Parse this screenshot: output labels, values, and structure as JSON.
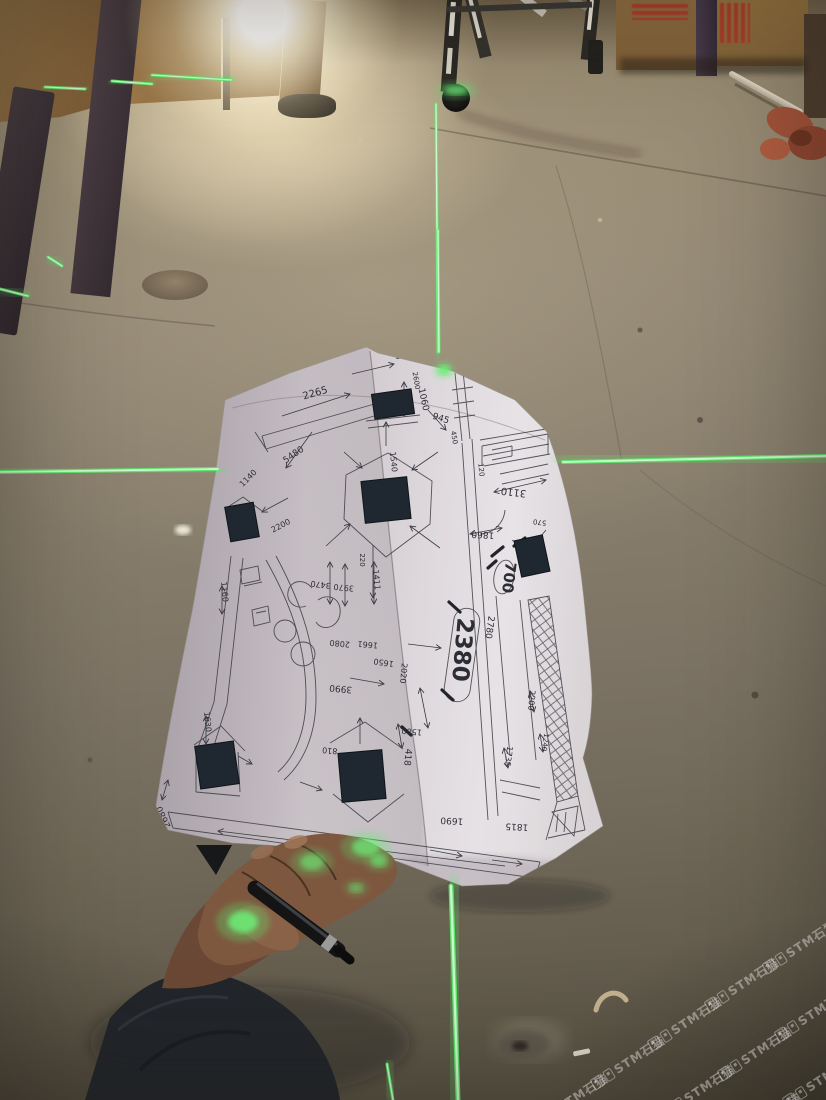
{
  "image": {
    "width": 826,
    "height": 1100
  },
  "colors": {
    "laser_green": "#5FE96C",
    "laser_core": "#D5FFD8",
    "paper_white": "#D8D2D6",
    "floor_brown": "#857B6A",
    "crate_wood": "#937042",
    "crate_print_red": "#B83426",
    "pillar_purple": "#443748",
    "pen_black": "#141414",
    "jacket_dark": "#22252A",
    "skin_shadow": "#6E4B38",
    "ink": "#2D2D36",
    "watermark_white": "#FFFFFF"
  },
  "watermark": {
    "text": "STM石猫",
    "icon": "stone-cat-logo-icon",
    "color": "#ffffff",
    "opacity": 0.38,
    "angle_deg": -33,
    "tiles": [
      [
        800,
        946
      ],
      [
        742,
        984
      ],
      [
        685,
        1023
      ],
      [
        628,
        1062
      ],
      [
        571,
        1100
      ],
      [
        812,
        1014
      ],
      [
        755,
        1053
      ],
      [
        698,
        1091
      ],
      [
        820,
        1080
      ],
      [
        764,
        1119
      ]
    ]
  },
  "laser": {
    "color": "#5FE96C",
    "segments": [
      {
        "x1": 0,
        "y1": 472,
        "x2": 218,
        "y2": 469,
        "w": 4,
        "glow": 9
      },
      {
        "x1": 563,
        "y1": 462,
        "x2": 826,
        "y2": 456,
        "w": 4,
        "glow": 9
      },
      {
        "x1": 436,
        "y1": 104,
        "x2": 438,
        "y2": 352,
        "w": 3,
        "glow": 6
      },
      {
        "x1": 438,
        "y1": 230,
        "x2": 439,
        "y2": 352,
        "w": 3,
        "glow": 7
      },
      {
        "x1": 451,
        "y1": 886,
        "x2": 458,
        "y2": 1100,
        "w": 5,
        "glow": 11
      },
      {
        "x1": 45,
        "y1": 87,
        "x2": 85,
        "y2": 89,
        "w": 3,
        "glow": 5
      },
      {
        "x1": 112,
        "y1": 81,
        "x2": 152,
        "y2": 84,
        "w": 3,
        "glow": 5
      },
      {
        "x1": 152,
        "y1": 75,
        "x2": 232,
        "y2": 80,
        "w": 3,
        "glow": 5
      },
      {
        "x1": 48,
        "y1": 257,
        "x2": 62,
        "y2": 266,
        "w": 3,
        "glow": 5
      },
      {
        "x1": 0,
        "y1": 289,
        "x2": 28,
        "y2": 296,
        "w": 3,
        "glow": 5
      },
      {
        "x1": 387,
        "y1": 1064,
        "x2": 393,
        "y2": 1100,
        "w": 3,
        "glow": 6
      }
    ],
    "spots": [
      {
        "cx": 444,
        "cy": 370,
        "rx": 6,
        "ry": 5,
        "o": 0.95
      },
      {
        "cx": 456,
        "cy": 90,
        "rx": 12,
        "ry": 5,
        "o": 0.7
      },
      {
        "cx": 243,
        "cy": 922,
        "rx": 15,
        "ry": 11,
        "o": 0.85
      },
      {
        "cx": 312,
        "cy": 862,
        "rx": 12,
        "ry": 8,
        "o": 0.6
      },
      {
        "cx": 366,
        "cy": 847,
        "rx": 14,
        "ry": 9,
        "o": 0.7
      },
      {
        "cx": 379,
        "cy": 861,
        "rx": 8,
        "ry": 6,
        "o": 0.6
      },
      {
        "cx": 356,
        "cy": 888,
        "rx": 7,
        "ry": 5,
        "o": 0.45
      }
    ]
  },
  "blueprint": {
    "labels": [
      {
        "t": "2160",
        "x": 406,
        "y": 357,
        "r": -12,
        "s": 8
      },
      {
        "t": "965",
        "x": 443,
        "y": 364,
        "r": -10,
        "s": 8
      },
      {
        "t": "2265",
        "x": 316,
        "y": 396,
        "r": -16,
        "s": 10
      },
      {
        "t": "2600",
        "x": 414,
        "y": 381,
        "r": 80,
        "s": 7
      },
      {
        "t": "1060",
        "x": 421,
        "y": 400,
        "r": 78,
        "s": 9
      },
      {
        "t": "945",
        "x": 440,
        "y": 421,
        "r": 18,
        "s": 9
      },
      {
        "t": "5480",
        "x": 295,
        "y": 457,
        "r": -35,
        "s": 9
      },
      {
        "t": "1540",
        "x": 391,
        "y": 462,
        "r": 85,
        "s": 8
      },
      {
        "t": "1140",
        "x": 250,
        "y": 480,
        "r": -45,
        "s": 8
      },
      {
        "t": "450",
        "x": 452,
        "y": 438,
        "r": 80,
        "s": 7
      },
      {
        "t": "120",
        "x": 479,
        "y": 470,
        "r": 85,
        "s": 7
      },
      {
        "t": "3110",
        "x": 514,
        "y": 489,
        "r": 187,
        "s": 10
      },
      {
        "t": "570",
        "x": 540,
        "y": 520,
        "r": 187,
        "s": 7
      },
      {
        "t": "1860",
        "x": 483,
        "y": 532,
        "r": 183,
        "s": 9
      },
      {
        "t": "700",
        "x": 504,
        "y": 577,
        "r": 97,
        "s": 15,
        "b": true
      },
      {
        "t": "2200",
        "x": 282,
        "y": 528,
        "r": -28,
        "s": 8
      },
      {
        "t": "3470",
        "x": 321,
        "y": 582,
        "r": 187,
        "s": 8
      },
      {
        "t": "3970",
        "x": 344,
        "y": 585,
        "r": 185,
        "s": 8
      },
      {
        "t": "1411",
        "x": 374,
        "y": 580,
        "r": 85,
        "s": 8
      },
      {
        "t": "220",
        "x": 360,
        "y": 560,
        "r": 90,
        "s": 7
      },
      {
        "t": "1160",
        "x": 222,
        "y": 592,
        "r": 85,
        "s": 8
      },
      {
        "t": "2080",
        "x": 340,
        "y": 641,
        "r": 185,
        "s": 8
      },
      {
        "t": "3990",
        "x": 341,
        "y": 686,
        "r": 185,
        "s": 9
      },
      {
        "t": "1650",
        "x": 384,
        "y": 660,
        "r": 188,
        "s": 8
      },
      {
        "t": "1661",
        "x": 368,
        "y": 642,
        "r": 185,
        "s": 8
      },
      {
        "t": "2020",
        "x": 401,
        "y": 673,
        "r": 95,
        "s": 8
      },
      {
        "t": "2380",
        "x": 455,
        "y": 649,
        "r": 95,
        "s": 23,
        "b": true
      },
      {
        "t": "2780",
        "x": 487,
        "y": 627,
        "r": 98,
        "s": 9
      },
      {
        "t": "1580",
        "x": 412,
        "y": 729,
        "r": 185,
        "s": 8
      },
      {
        "t": "418",
        "x": 405,
        "y": 757,
        "r": 95,
        "s": 9
      },
      {
        "t": "810",
        "x": 330,
        "y": 748,
        "r": 185,
        "s": 8
      },
      {
        "t": "1630",
        "x": 205,
        "y": 722,
        "r": 85,
        "s": 8
      },
      {
        "t": "1735",
        "x": 506,
        "y": 756,
        "r": 98,
        "s": 8
      },
      {
        "t": "2200",
        "x": 529,
        "y": 700,
        "r": 95,
        "s": 8
      },
      {
        "t": "1240",
        "x": 543,
        "y": 742,
        "r": 98,
        "s": 7
      },
      {
        "t": "1690",
        "x": 452,
        "y": 818,
        "r": 183,
        "s": 9
      },
      {
        "t": "1815",
        "x": 517,
        "y": 824,
        "r": 183,
        "s": 9
      },
      {
        "t": "2680",
        "x": 166,
        "y": 816,
        "r": 245,
        "s": 9
      }
    ],
    "columns": [
      {
        "x": 393,
        "y": 404,
        "w": 40,
        "h": 25,
        "r": -8
      },
      {
        "x": 242,
        "y": 522,
        "w": 29,
        "h": 35,
        "r": -10
      },
      {
        "x": 386,
        "y": 500,
        "w": 46,
        "h": 42,
        "r": -6
      },
      {
        "x": 532,
        "y": 556,
        "w": 29,
        "h": 37,
        "r": -12
      },
      {
        "x": 217,
        "y": 765,
        "w": 39,
        "h": 43,
        "r": -8
      },
      {
        "x": 362,
        "y": 776,
        "w": 44,
        "h": 49,
        "r": -5
      }
    ]
  }
}
